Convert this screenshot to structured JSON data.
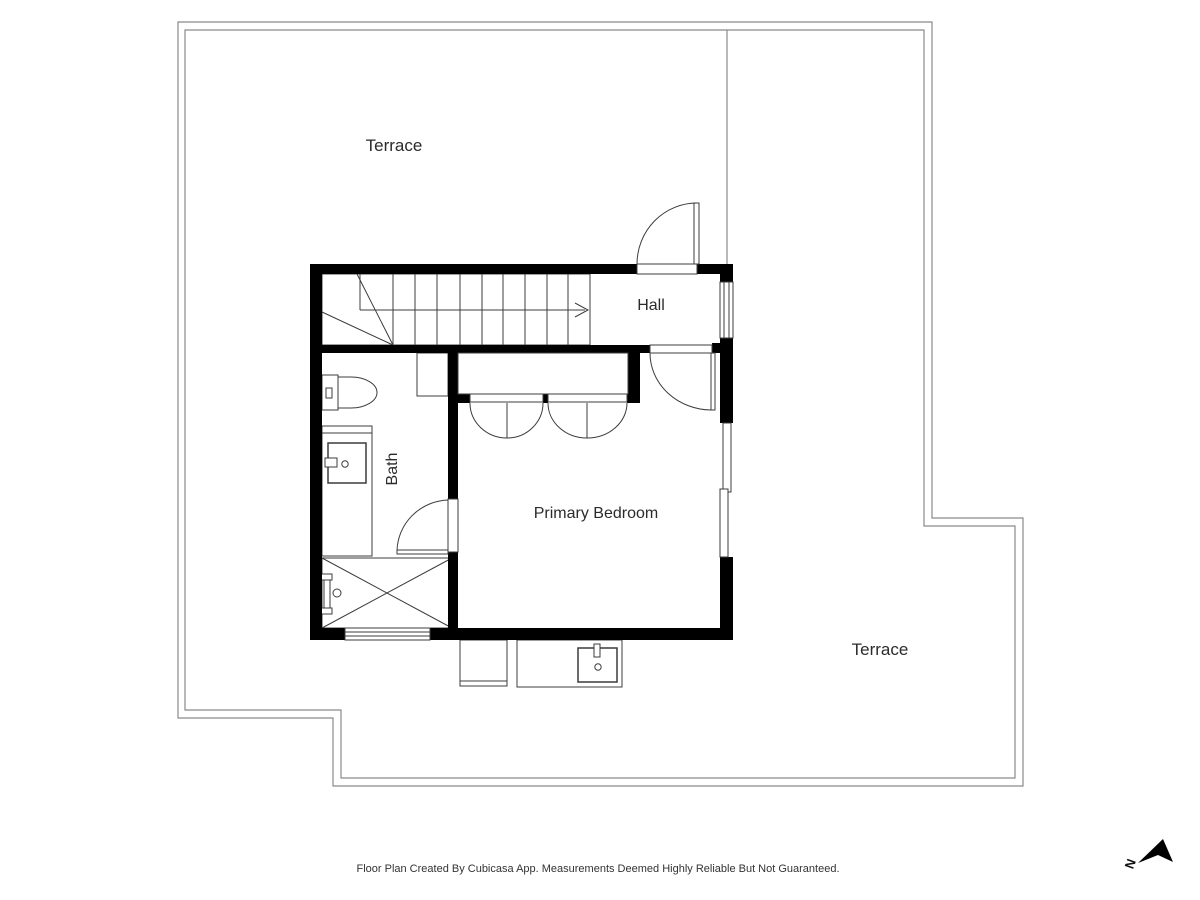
{
  "plan": {
    "rooms": {
      "terrace_top": "Terrace",
      "hall": "Hall",
      "bath": "Bath",
      "primary_bedroom": "Primary Bedroom",
      "terrace_bottom": "Terrace"
    },
    "compass": {
      "north_label": "N"
    },
    "footer": {
      "disclaimer": "Floor Plan Created By Cubicasa App. Measurements Deemed Highly Reliable But Not Guaranteed."
    },
    "colors": {
      "wall": "#000000",
      "fixture_line": "#4d4d4d",
      "boundary_line": "#8a8a8a",
      "text": "#2b2b2b",
      "background": "#ffffff"
    }
  }
}
